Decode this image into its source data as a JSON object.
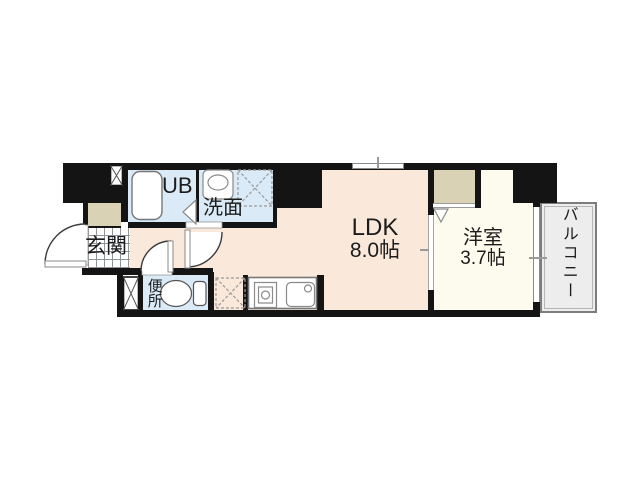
{
  "floorplan": {
    "rooms": {
      "genkan": {
        "label": "玄関"
      },
      "unit_bath": {
        "label": "UB"
      },
      "washroom": {
        "label": "洗面"
      },
      "toilet": {
        "label": "便所"
      },
      "ldk": {
        "label": "LDK",
        "size": "8.0帖"
      },
      "western_room": {
        "label": "洋室",
        "size": "3.7帖"
      },
      "balcony": {
        "label": "バルコニー"
      }
    },
    "colors": {
      "wall": "#141414",
      "main_floor": "#fae8da",
      "western_floor": "#fdfbee",
      "wet_area": "#daeaf6",
      "closet": "#d9d2b5",
      "balcony": "#ededee",
      "fixture_line": "#8a8a8a"
    }
  }
}
